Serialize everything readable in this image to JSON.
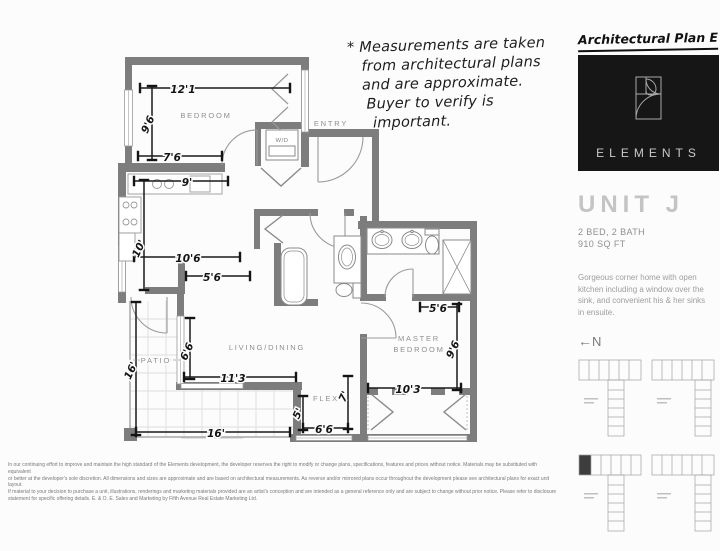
{
  "note": {
    "line1": "* Measurements are taken",
    "line2": "from architectural plans",
    "line3": "and are approximate.",
    "line4": "Buyer to verify is",
    "line5": "important."
  },
  "sidebar": {
    "plan_label": "Architectural Plan E",
    "brand": "ELEMENTS",
    "unit_name": "UNIT J",
    "spec1": "2 BED, 2 BATH",
    "spec2": "910 SQ FT",
    "desc1": "Gorgeous corner home with open",
    "desc2": "kitchen including a window over the",
    "desc3": "sink, and convenient his & her sinks",
    "desc4": "in ensuite.",
    "north_label": "N",
    "north_arrow": "←"
  },
  "plan": {
    "rooms": {
      "bedroom": "BEDROOM",
      "entry": "ENTRY",
      "wd": "W/D",
      "living": "LIVING/DINING",
      "patio": "PATIO",
      "flex": "FLEX",
      "master1": "MASTER",
      "master2": "BEDROOM"
    },
    "dims": {
      "bed_w": "12'1",
      "bed_h": "9'6",
      "bed_b": "7'6",
      "kit_t": "9'",
      "kit_h": "10'",
      "kit_w": "10'6",
      "kit_w2": "5'6",
      "liv_h": "6'6",
      "liv_w": "11'3",
      "liv_b": "16'",
      "patio_h": "16'",
      "flex_h": "5'",
      "flex_h2": "7'",
      "flex_w": "6'6",
      "mbr_t": "5'6",
      "mbr_h": "9'6",
      "mbr_w": "10'3"
    }
  },
  "disclaimer": {
    "line1": "In our continuing effort to improve and maintain the high standard of the Elements development, the developer reserves the right to modify or change plans, specifications, features and prices without notice. Materials may be substituted with equivalent",
    "line2": "or better at the developer's sole discretion. All dimensions and sizes are approximate and are based on architectural measurements. As reverse and/or mirrored plans occur throughout the development please see architectural plans for exact unit layout.",
    "line3": "If material to your decision to purchase a unit, illustrations, renderings and marketing materials provided are an artist's conception and are intended as a general reference only and are subject to change without prior notice. Please refer to disclosure",
    "line4": "statement for specific offering details. E. & O. E. Sales and Marketing by Fifth Avenue Real Estate Marketing Ltd."
  }
}
